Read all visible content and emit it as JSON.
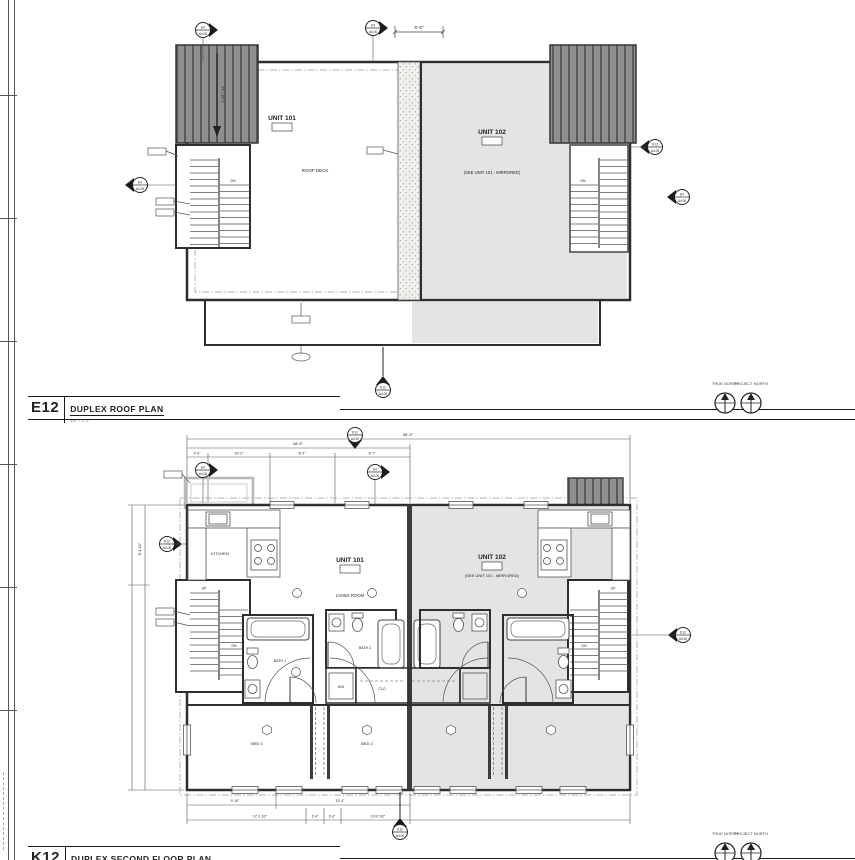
{
  "sheet": {
    "north_true": "TRUE NORTH",
    "north_project": "PROJECT NORTH"
  },
  "roof_plan": {
    "id": "E12",
    "title": "DUPLEX ROOF PLAN",
    "scale": "1/4\" = 1'-0\"",
    "unit101_name": "UNIT 101",
    "unit102_name": "UNIT 102",
    "roof_deck": "ROOF DECK",
    "mirror_note": "(SEE UNIT 101 - MIRRORED)",
    "dn": "DN",
    "slope": "1 1/2\" / 12\"",
    "dim_top": "6'-0\""
  },
  "floor_plan": {
    "id": "K12",
    "title": "DUPLEX SECOND FLOOR PLAN",
    "scale": "1/4\" = 1'-0\"",
    "unit101_name": "UNIT 101",
    "unit102_name": "UNIT 102",
    "living_room": "LIVING ROOM",
    "kitchen": "KITCHEN",
    "bath1": "BATH 1",
    "bath2": "BATH 2",
    "wd": "W/D",
    "clo": "CLO",
    "bed1": "BED 1",
    "bed2": "BED 2",
    "up": "UP",
    "dn": "DN",
    "mirror_note": "(SEE UNIT 101 - MIRRORED)",
    "dims": {
      "overall": "56'-0\"",
      "half": "28'-0\"",
      "seg1": "4'-2\"",
      "seg2": "10'-2\"",
      "seg3": "8'-2\"",
      "seg4": "8'-7\"",
      "left_height": "8'-4 1/2\"",
      "b1a": "9'-10\"",
      "b1b": "13'-0\"",
      "b2a": "17'-1 1/2\"",
      "b2b": "2'-4\"",
      "b2c": "3'-0\"",
      "b2d": "10'-0 1/2\""
    }
  },
  "markers": {
    "e4": {
      "top": "E4",
      "bot": "A4.00"
    },
    "e12": {
      "top": "E12",
      "bot": "A4.00"
    },
    "k12": {
      "top": "K12",
      "bot": "A4.00"
    }
  }
}
